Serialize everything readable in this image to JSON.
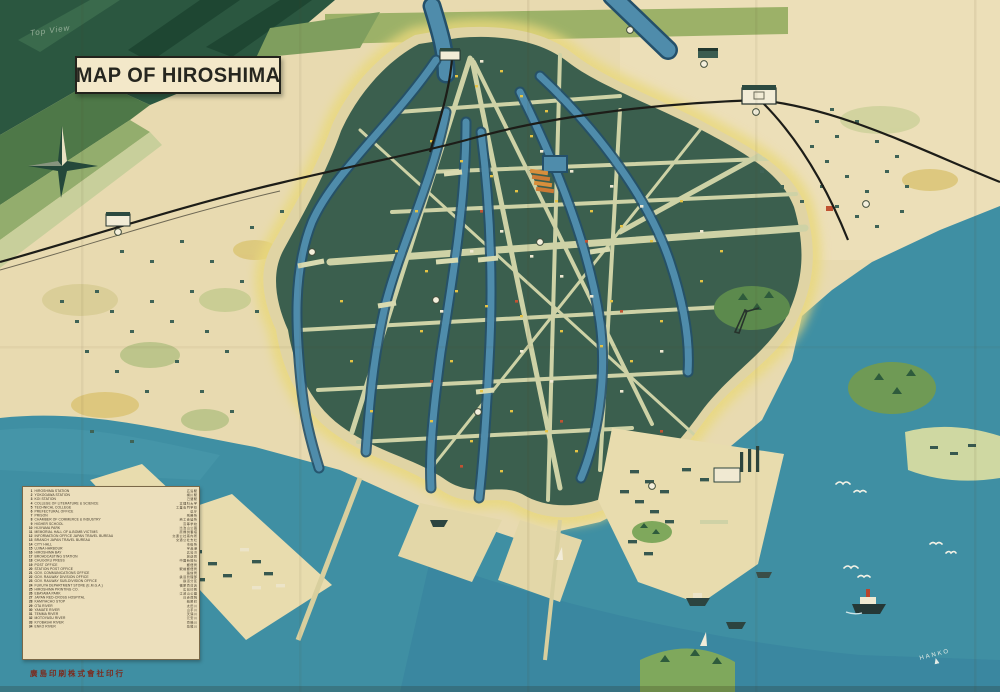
{
  "meta": {
    "pencil_note": "Top View"
  },
  "title": {
    "text": "MAP OF HIROSHIMA"
  },
  "publisher": {
    "text": "廣島印刷株式會社印行"
  },
  "printers_mark": {
    "text": "HANKO"
  },
  "colors": {
    "paper": "#e8dab0",
    "sea": "#3f8fa3",
    "city_green": "#3b5f4e",
    "mountain_green": "#2b5740",
    "road": "#ced2a6",
    "river": "#4f8cab",
    "glow": "#e9d87c",
    "accent_orange": "#c96434",
    "building_yellow": "#e5c344",
    "legend_bg": "#ecdfbc",
    "publisher_red": "#7c2b1e"
  },
  "legend": {
    "items": [
      {
        "num": "1",
        "name": "HIROSHIMA STATION",
        "jp": "広島駅"
      },
      {
        "num": "2",
        "name": "YOKOGAWA STATION",
        "jp": "横川駅"
      },
      {
        "num": "3",
        "name": "KOI STATION",
        "jp": "己斐駅"
      },
      {
        "num": "4",
        "name": "COLLEGE OF LITERATURE & SCIENCE",
        "jp": "文理科大学"
      },
      {
        "num": "5",
        "name": "TECHNICAL COLLEGE",
        "jp": "工業専門学校"
      },
      {
        "num": "6",
        "name": "PREFECTURAL OFFICE",
        "jp": "県庁"
      },
      {
        "num": "7",
        "name": "PRISON",
        "jp": "刑務所"
      },
      {
        "num": "8",
        "name": "CHAMBER OF COMMERCE & INDUSTRY",
        "jp": "商工会議所"
      },
      {
        "num": "9",
        "name": "HIGHER SCHOOL",
        "jp": "高等学校"
      },
      {
        "num": "10",
        "name": "HIJIYAMA PARK",
        "jp": "比治山公園"
      },
      {
        "num": "11",
        "name": "MEMORIAL HALL OF A-BOMB VICTIMS",
        "jp": "原爆供養塔"
      },
      {
        "num": "12",
        "name": "INFORMATION OFFICE JAPAN TRAVEL BUREAU",
        "jp": "交通公社案内所"
      },
      {
        "num": "13",
        "name": "BRANCH JAPAN TRAVEL BUREAU",
        "jp": "交通公社支社"
      },
      {
        "num": "14",
        "name": "CITY HALL",
        "jp": "市役所"
      },
      {
        "num": "15",
        "name": "UJINA HARBOUR",
        "jp": "宇品港"
      },
      {
        "num": "16",
        "name": "HIROSHIMA BAY",
        "jp": "広島湾"
      },
      {
        "num": "17",
        "name": "BROADCASTING STATION",
        "jp": "放送局"
      },
      {
        "num": "18",
        "name": "CHUGOKU PRESS",
        "jp": "中国新聞社"
      },
      {
        "num": "19",
        "name": "POST OFFICE",
        "jp": "郵便局"
      },
      {
        "num": "20",
        "name": "STATION POST OFFICE",
        "jp": "駅前郵便局"
      },
      {
        "num": "21",
        "name": "GOV. COMMUNICATIONS OFFICE",
        "jp": "逓信局"
      },
      {
        "num": "22",
        "name": "GOV. RAILWAY DIVISION OFFICE",
        "jp": "鉄道管理部"
      },
      {
        "num": "23",
        "name": "GOV. RAILWAY SUB-DIVISION OFFICE",
        "jp": "鉄道分区"
      },
      {
        "num": "24",
        "name": "FUKUYA DEPARTMENT STORE (E.M.G.A.)",
        "jp": "福屋百貨店"
      },
      {
        "num": "25",
        "name": "HIROSHIMA PRINTING CO.",
        "jp": "広島印刷"
      },
      {
        "num": "26",
        "name": "EBAYAMA PARK",
        "jp": "江波山公園"
      },
      {
        "num": "27",
        "name": "JAPAN RED-CROSS HOSPITAL",
        "jp": "日赤病院"
      },
      {
        "num": "28",
        "name": "KAMIYACHO STOP",
        "jp": "紙屋町"
      },
      {
        "num": "29",
        "name": "OTA RIVER",
        "jp": "太田川"
      },
      {
        "num": "30",
        "name": "YAMATE RIVER",
        "jp": "山手川"
      },
      {
        "num": "31",
        "name": "TEMMA RIVER",
        "jp": "天満川"
      },
      {
        "num": "32",
        "name": "MOTOYASU RIVER",
        "jp": "元安川"
      },
      {
        "num": "33",
        "name": "KYOBASHI RIVER",
        "jp": "京橋川"
      },
      {
        "num": "34",
        "name": "ENKO RIVER",
        "jp": "猿猴川"
      }
    ]
  }
}
